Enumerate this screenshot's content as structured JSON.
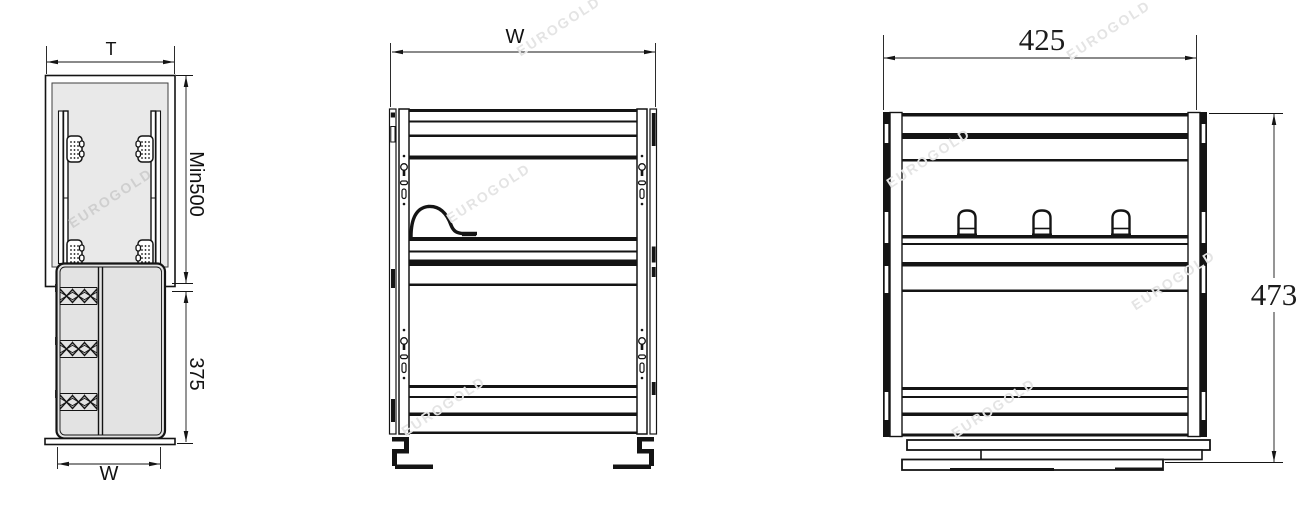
{
  "watermark": {
    "text": "EUROGOLD"
  },
  "views": {
    "side": {
      "dim_width_top": "T",
      "dim_height_upper": "Min500",
      "dim_height_lower": "375",
      "dim_width_bottom": "W"
    },
    "front": {
      "dim_width": "W"
    },
    "dimensioned": {
      "dim_width": "425",
      "dim_height": "473"
    }
  }
}
